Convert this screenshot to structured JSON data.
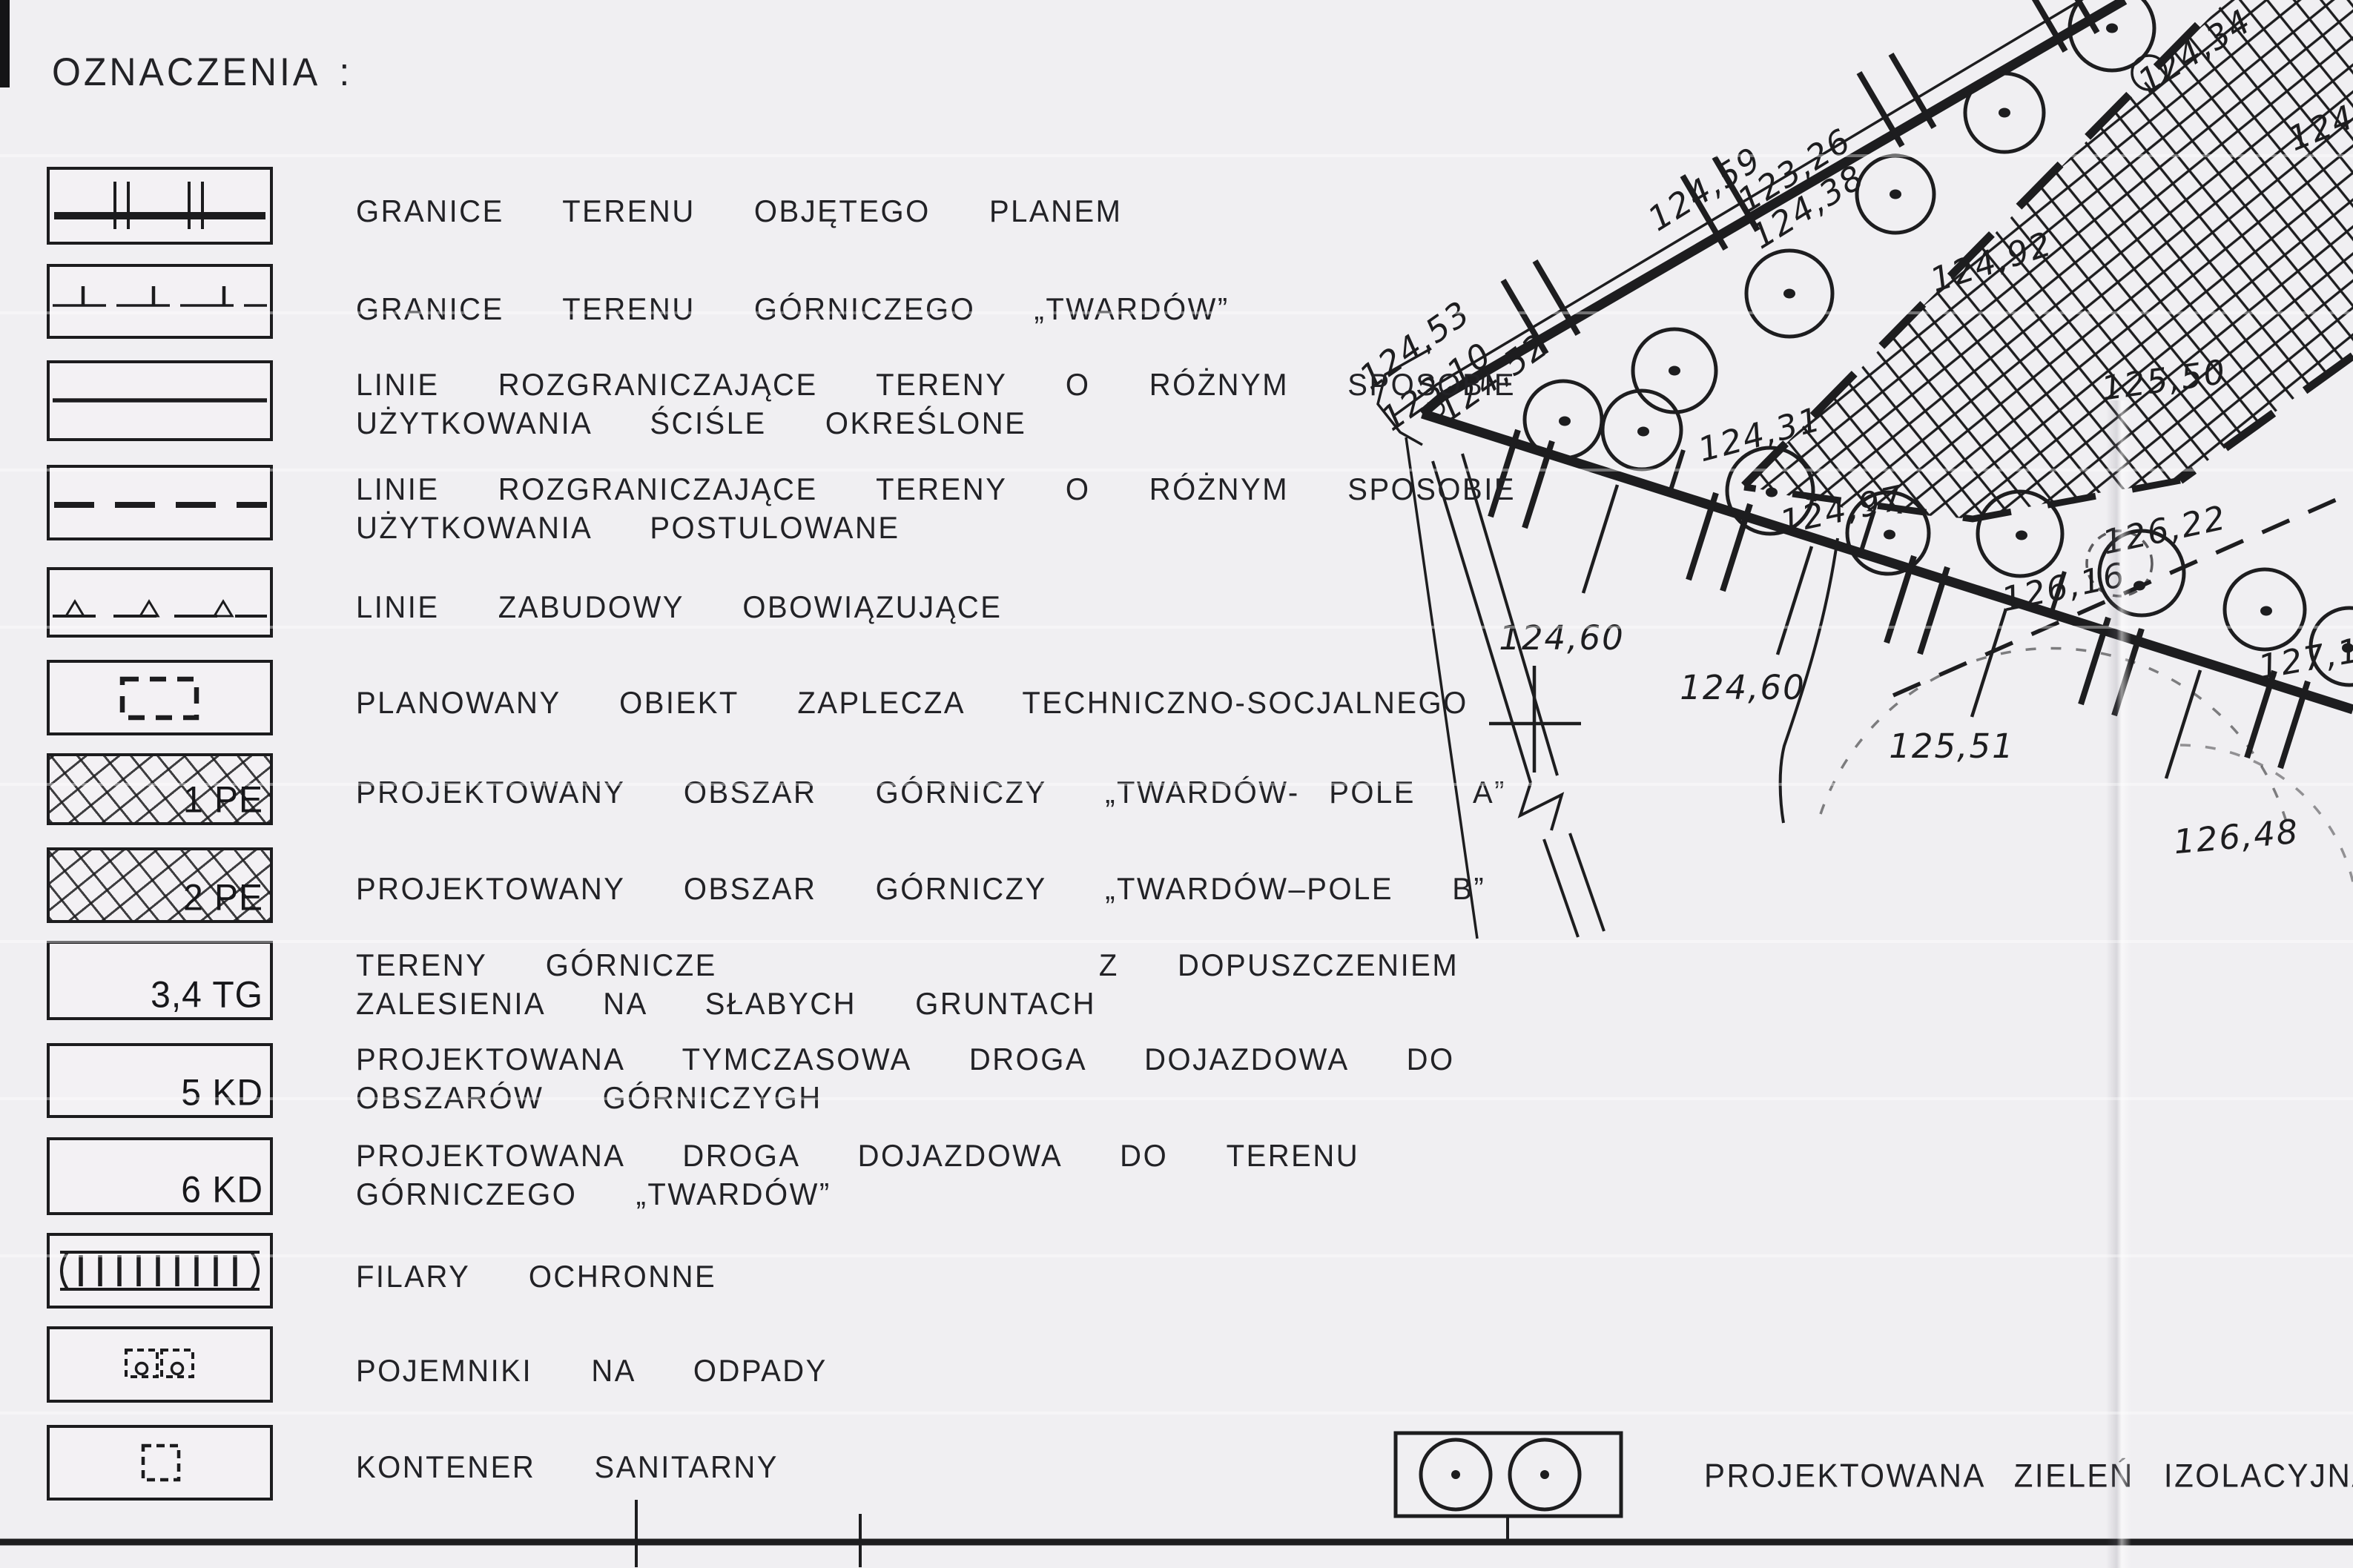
{
  "title": "OZNACZENIA :",
  "legend": {
    "items": [
      {
        "code": "",
        "lines": [
          "GRANICE  TERENU  OBJĘTEGO  PLANEM"
        ]
      },
      {
        "code": "",
        "lines": [
          "GRANICE  TERENU  GÓRNICZEGO  „TWARDÓW”"
        ]
      },
      {
        "code": "",
        "lines": [
          "LINIE  ROZGRANICZAJĄCE  TERENY  O  RÓŻNYM  SPOSOBIE",
          "UŻYTKOWANIA  ŚCIŚLE  OKREŚLONE"
        ]
      },
      {
        "code": "",
        "lines": [
          "LINIE  ROZGRANICZAJĄCE  TERENY  O  RÓŻNYM  SPOSOBIE",
          "UŻYTKOWANIA  POSTULOWANE"
        ]
      },
      {
        "code": "",
        "lines": [
          "LINIE  ZABUDOWY  OBOWIĄZUJĄCE"
        ]
      },
      {
        "code": "",
        "lines": [
          "PLANOWANY  OBIEKT  ZAPLECZA  TECHNICZNO-SOCJALNEGO"
        ]
      },
      {
        "code": "1 PE",
        "lines": [
          "PROJEKTOWANY  OBSZAR  GÓRNICZY  „TWARDÓW- POLE  A”"
        ]
      },
      {
        "code": "2 PE",
        "lines": [
          "PROJEKTOWANY  OBSZAR  GÓRNICZY  „TWARDÓW–POLE  B”"
        ]
      },
      {
        "code": "3,4 TG",
        "lines": [
          "TERENY  GÓRNICZE             Z  DOPUSZCZENIEM",
          "ZALESIENIA  NA  SŁABYCH  GRUNTACH"
        ]
      },
      {
        "code": "5 KD",
        "lines": [
          "PROJEKTOWANA  TYMCZASOWA  DROGA  DOJAZDOWA  DO",
          "OBSZARÓW  GÓRNICZYGH"
        ]
      },
      {
        "code": "6 KD",
        "lines": [
          "PROJEKTOWANA  DROGA  DOJAZDOWA  DO  TERENU",
          "GÓRNICZEGO  „TWARDÓW”"
        ]
      },
      {
        "code": "",
        "lines": [
          "FILARY  OCHRONNE"
        ]
      },
      {
        "code": "",
        "lines": [
          "POJEMNIKI  NA  ODPADY"
        ]
      },
      {
        "code": "",
        "lines": [
          "KONTENER  SANITARNY"
        ]
      }
    ]
  },
  "map": {
    "green_label": "PROJEKTOWANA  ZIELEŃ   IZOLACYJNA",
    "labels": [
      {
        "value": "124,53"
      },
      {
        "value": "123,10"
      },
      {
        "value": "124,52"
      },
      {
        "value": "124,59"
      },
      {
        "value": "123,26"
      },
      {
        "value": "124,38"
      },
      {
        "value": "124,34"
      },
      {
        "value": "124,6"
      },
      {
        "value": "124,31"
      },
      {
        "value": "124,92"
      },
      {
        "value": "125,50"
      },
      {
        "value": "124,97"
      },
      {
        "value": "126,22"
      },
      {
        "value": "126,16"
      },
      {
        "value": "127,15"
      },
      {
        "value": "124,60"
      },
      {
        "value": "124,60"
      },
      {
        "value": "125,51"
      },
      {
        "value": "126,48"
      }
    ]
  },
  "colors": {
    "paper": "#f0eff2",
    "ink": "#1d1d1f"
  }
}
